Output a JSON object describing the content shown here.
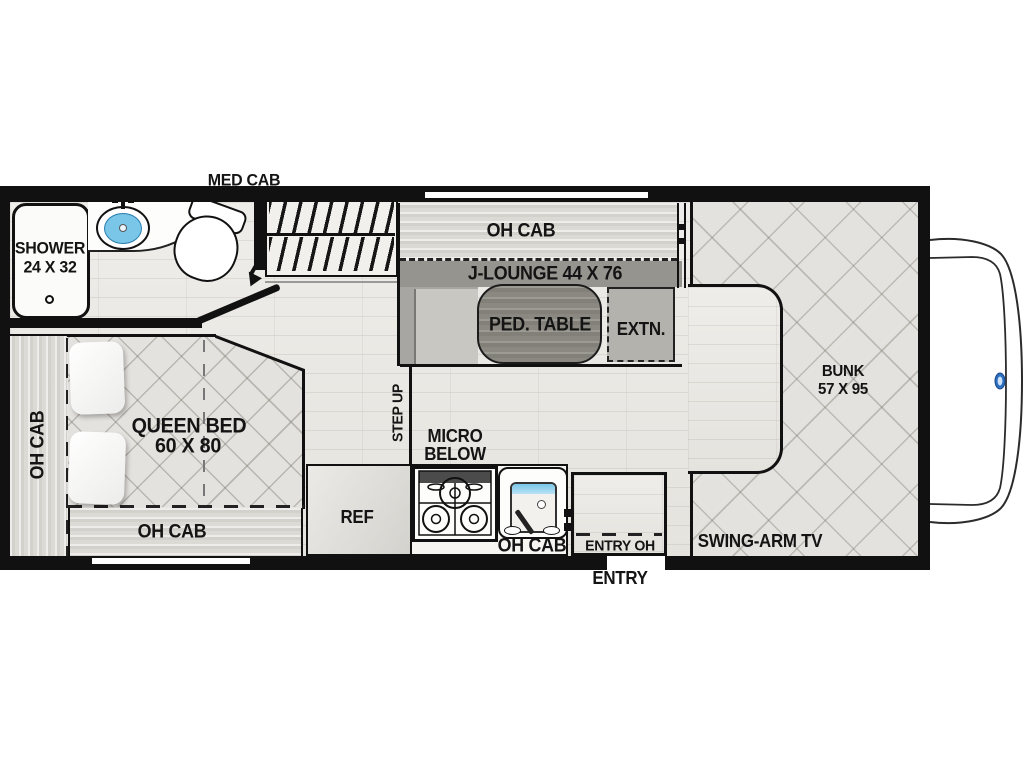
{
  "diagram_type": "rv-floorplan",
  "labels": {
    "med_cab": "MED CAB",
    "shower1": "SHOWER",
    "shower2": "24 X 32",
    "oh_cab_side": "OH CAB",
    "queen1": "QUEEN BED",
    "queen2": "60 X 80",
    "oh_cab_foot": "OH CAB",
    "step_up": "STEP UP",
    "oh_cab_lounge": "OH CAB",
    "j_lounge": "J-LOUNGE 44 X 76",
    "ped_table": "PED. TABLE",
    "extn": "EXTN.",
    "micro1": "MICRO",
    "micro2": "BELOW",
    "ref": "REF",
    "oh_cab_galley": "OH CAB",
    "entry_oh": "ENTRY OH",
    "entry": "ENTRY",
    "swing_arm_tv": "SWING-ARM TV",
    "bunk1": "BUNK",
    "bunk2": "57 X 95"
  },
  "colors": {
    "wall": "#111111",
    "floor": "#ebe9e5",
    "quilt": "#e4e2de",
    "cabinet": "#dcdad5",
    "lounge_back": "#96948f",
    "seat": "#c9c7c2",
    "ped_table": "#8a8880",
    "extn_seat": "#b4b2ad",
    "sink_water": "#7ac6e8",
    "ford_blue": "#2d6fc2",
    "label": "#141414",
    "shower": "#fbfbf9"
  }
}
